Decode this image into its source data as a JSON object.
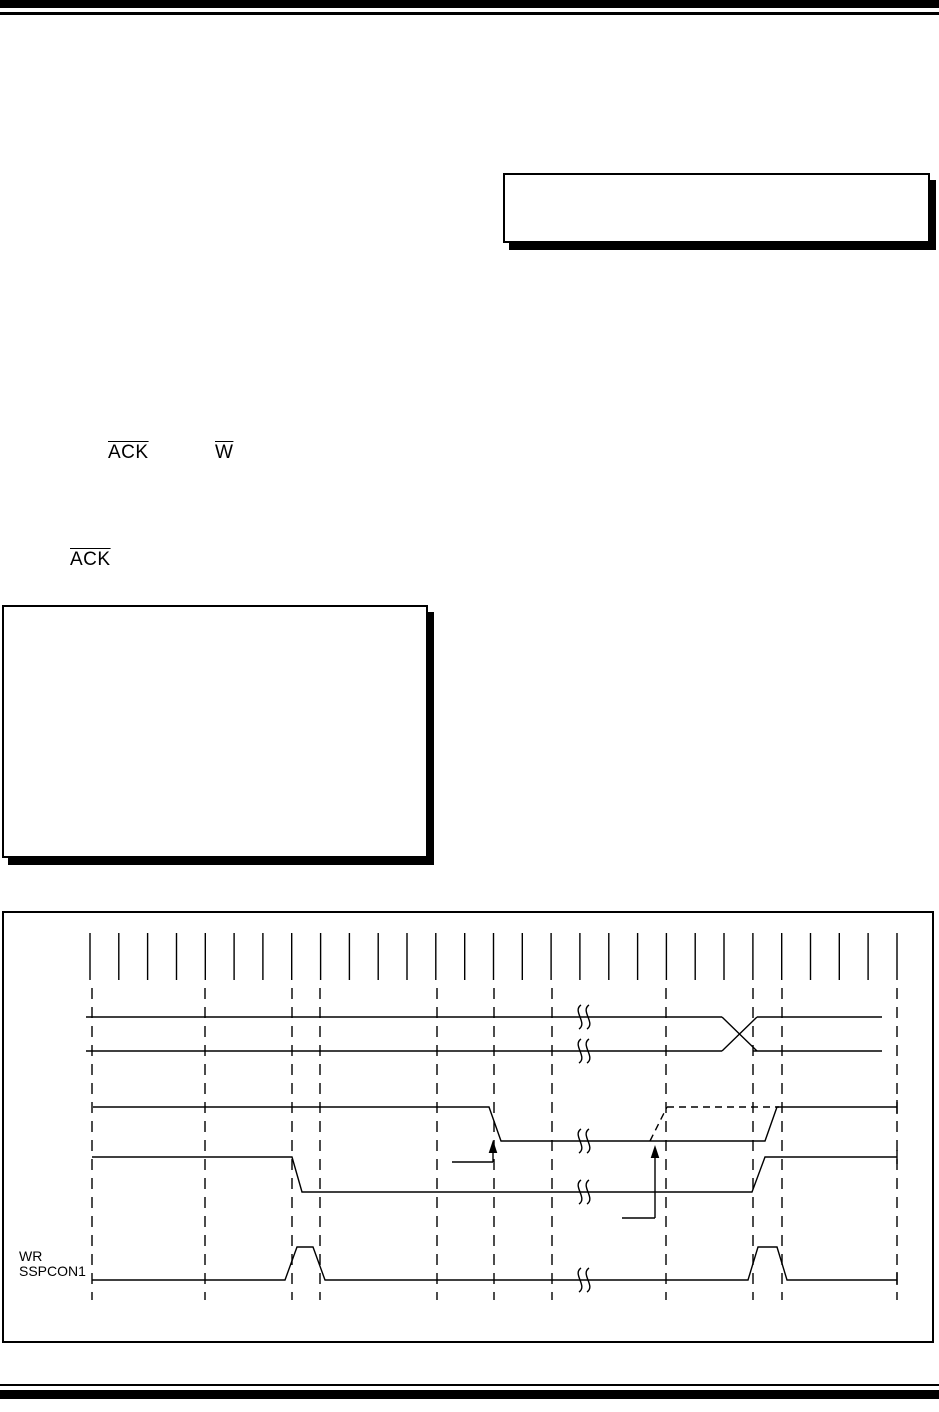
{
  "page": {
    "width": 939,
    "height": 1412,
    "background": "#ffffff",
    "ink_color": "#000000"
  },
  "text_fragments": {
    "ack_1": "ACK",
    "w_1": "W",
    "ack_2": "ACK"
  },
  "timing_figure": {
    "wr_label_line1": "WR",
    "wr_label_line2": "SSPCON1",
    "clock_ticks": {
      "x_start": 90,
      "spacing": 28.82,
      "count": 29,
      "y_top": 933,
      "y_bottom": 980
    },
    "dashed_verticals": {
      "x_positions": [
        92,
        205,
        292,
        320,
        437,
        494,
        552,
        666,
        753,
        782,
        897
      ],
      "y_top": 988,
      "y_bottom": 1300
    },
    "break_marks": {
      "x": 585,
      "row_y": [
        1017,
        1051,
        1141,
        1192,
        1280
      ]
    }
  }
}
